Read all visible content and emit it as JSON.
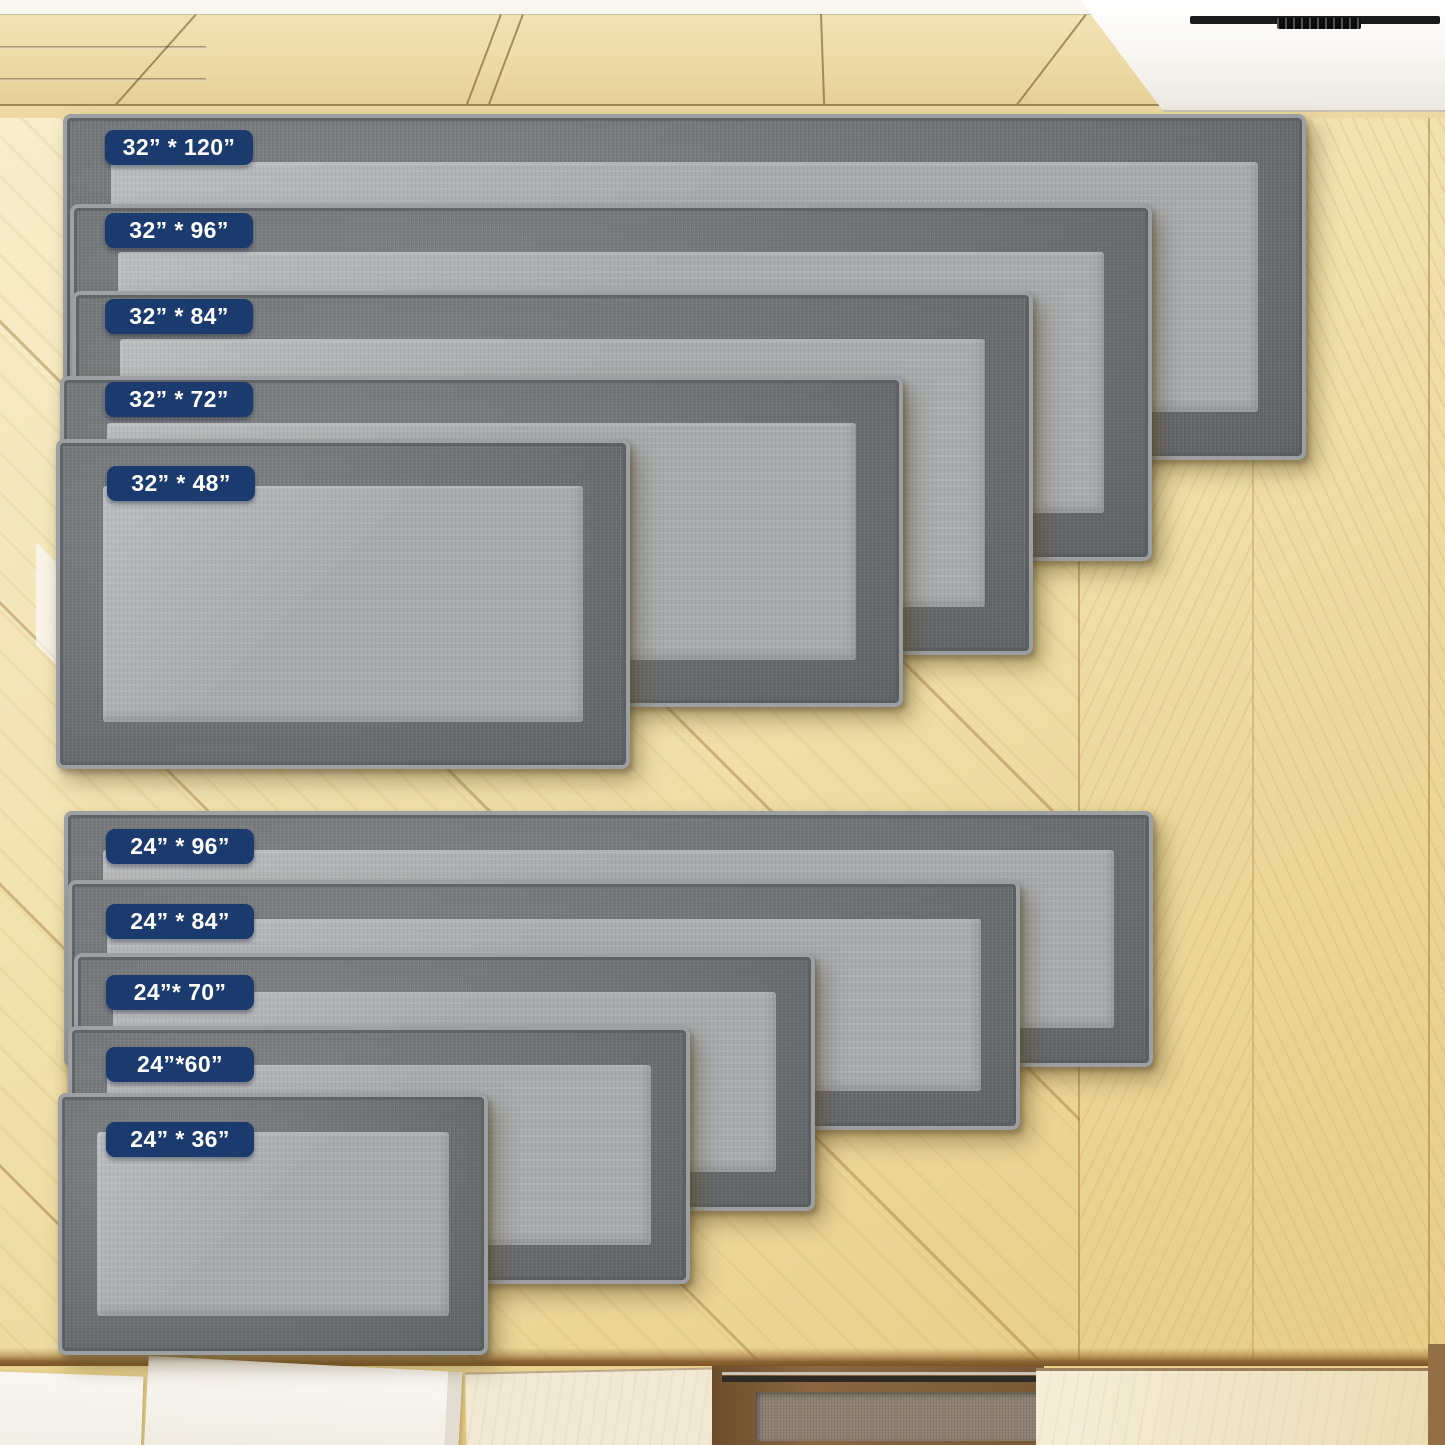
{
  "page": {
    "description": "Kitchen runner rug size comparison photo chart",
    "badge_bg": "#1b3a6e",
    "badge_text_color": "#ffffff",
    "rug_border_color": "#6e7174",
    "rug_center_color": "#a8abae",
    "floor_color": "#f1e1ad"
  },
  "rugs": [
    {
      "id": "32x120",
      "label": "32” * 120”",
      "width_in": 32,
      "length_in": 120,
      "x": 63,
      "y": 114,
      "w": 1243,
      "h": 346,
      "border": 48,
      "badge_dx": 42,
      "badge_dy": 16
    },
    {
      "id": "32x96",
      "label": "32” * 96”",
      "width_in": 32,
      "length_in": 96,
      "x": 70,
      "y": 204,
      "w": 1082,
      "h": 357,
      "border": 48,
      "badge_dx": 35,
      "badge_dy": 9
    },
    {
      "id": "32x84",
      "label": "32” * 84”",
      "width_in": 32,
      "length_in": 84,
      "x": 72,
      "y": 291,
      "w": 961,
      "h": 364,
      "border": 48,
      "badge_dx": 33,
      "badge_dy": 8
    },
    {
      "id": "32x72",
      "label": "32” * 72”",
      "width_in": 32,
      "length_in": 72,
      "x": 60,
      "y": 376,
      "w": 843,
      "h": 331,
      "border": 47,
      "badge_dx": 45,
      "badge_dy": 6
    },
    {
      "id": "32x48",
      "label": "32” * 48”",
      "width_in": 32,
      "length_in": 48,
      "x": 56,
      "y": 439,
      "w": 574,
      "h": 330,
      "border": 47,
      "badge_dx": 51,
      "badge_dy": 27
    },
    {
      "id": "24x96",
      "label": "24” * 96”",
      "width_in": 24,
      "length_in": 96,
      "x": 64,
      "y": 811,
      "w": 1089,
      "h": 256,
      "border": 39,
      "badge_dx": 42,
      "badge_dy": 18
    },
    {
      "id": "24x84",
      "label": "24” * 84”",
      "width_in": 24,
      "length_in": 84,
      "x": 68,
      "y": 880,
      "w": 952,
      "h": 250,
      "border": 39,
      "badge_dx": 38,
      "badge_dy": 24
    },
    {
      "id": "24x70",
      "label": "24”* 70”",
      "width_in": 24,
      "length_in": 70,
      "x": 74,
      "y": 953,
      "w": 741,
      "h": 258,
      "border": 39,
      "badge_dx": 32,
      "badge_dy": 22
    },
    {
      "id": "24x60",
      "label": "24”*60”",
      "width_in": 24,
      "length_in": 60,
      "x": 68,
      "y": 1026,
      "w": 622,
      "h": 258,
      "border": 39,
      "badge_dx": 38,
      "badge_dy": 21
    },
    {
      "id": "24x36",
      "label": "24” * 36”",
      "width_in": 24,
      "length_in": 36,
      "x": 58,
      "y": 1093,
      "w": 430,
      "h": 262,
      "border": 39,
      "badge_dx": 48,
      "badge_dy": 29
    }
  ]
}
